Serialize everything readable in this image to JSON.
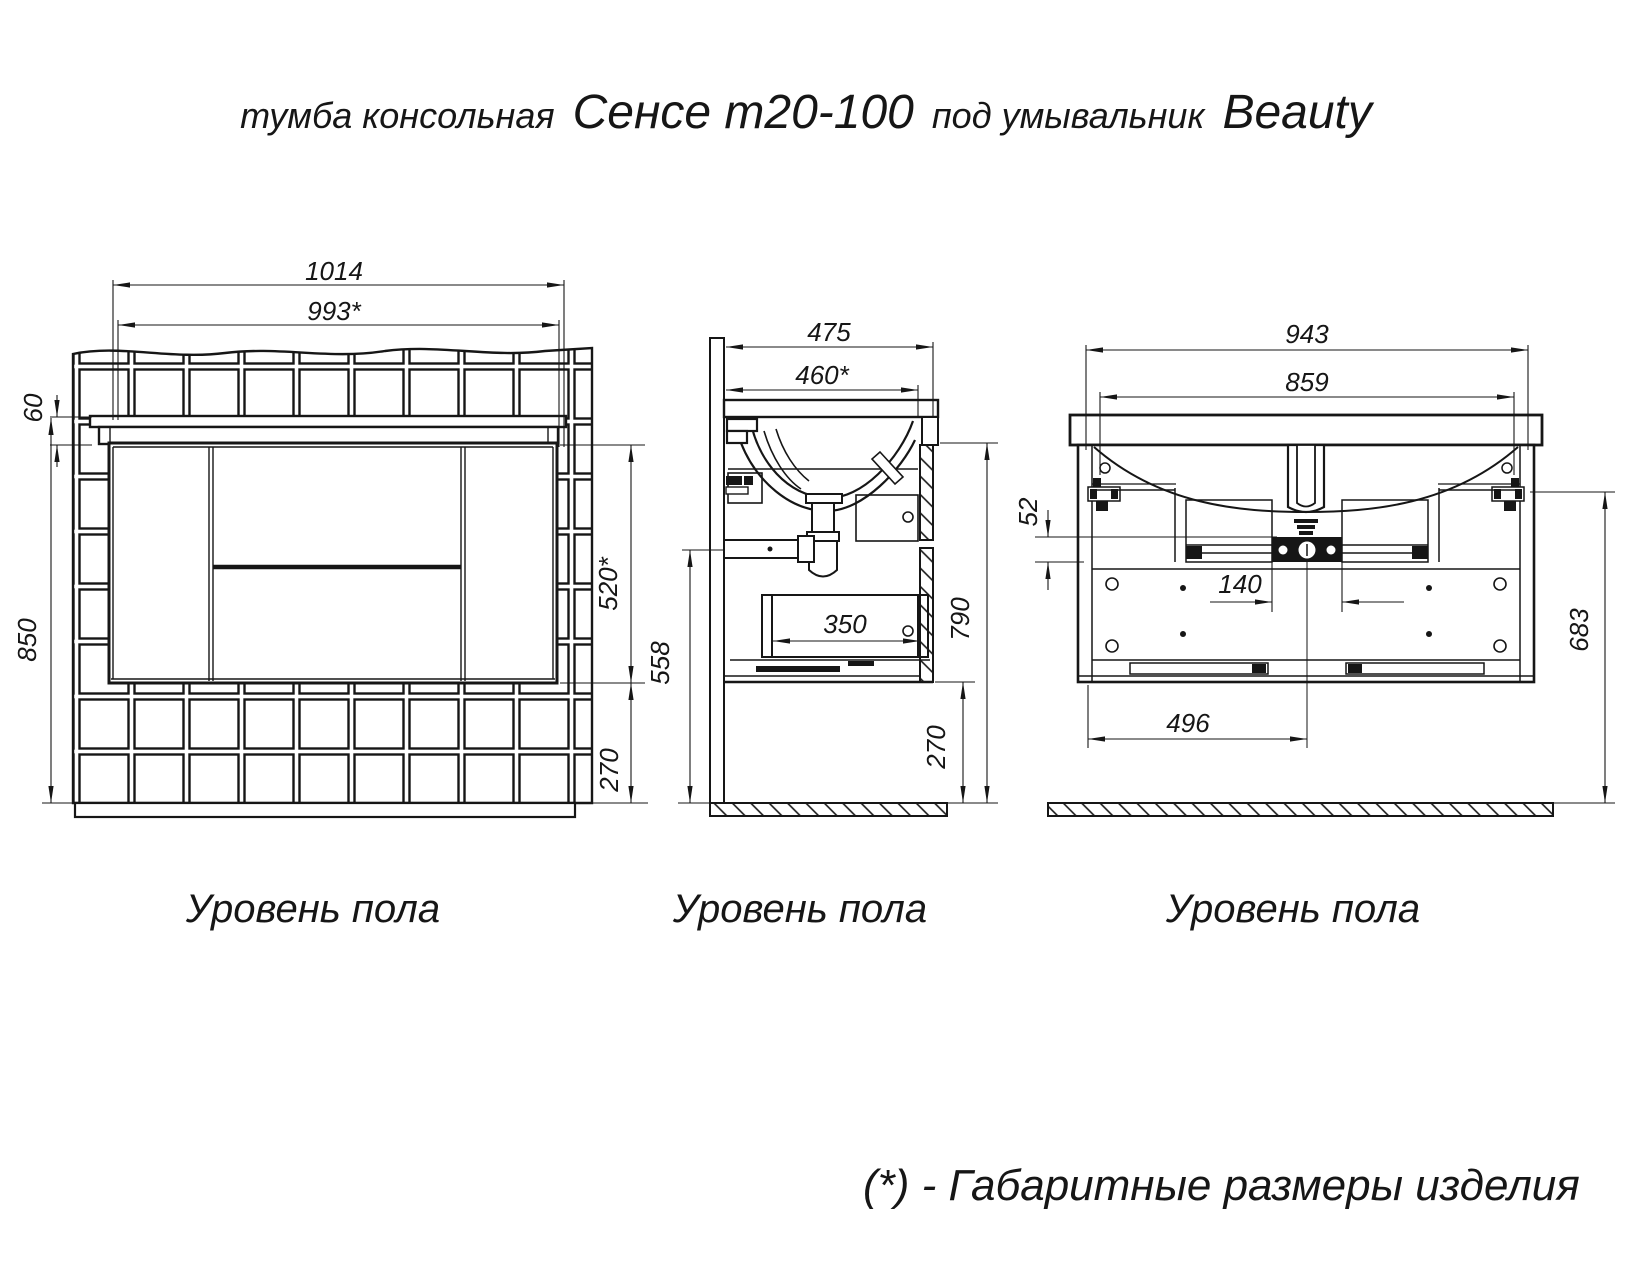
{
  "title": {
    "part1": "тумба консольная",
    "part2": "Сенсе т20-100",
    "part3": "под умывальник",
    "part4": "Beauty"
  },
  "views": {
    "front": {
      "floor_label": "Уровень пола",
      "dims": {
        "total_width": "1014",
        "product_width": "993*",
        "counter_height": "60",
        "total_height": "850",
        "cabinet_height": "520*",
        "floor_gap": "270"
      }
    },
    "side": {
      "floor_label": "Уровень пола",
      "dims": {
        "total_depth": "475",
        "product_depth": "460*",
        "drain_height": "558",
        "drawer_depth": "350",
        "front_height": "790",
        "floor_gap": "270"
      }
    },
    "back": {
      "floor_label": "Уровень пола",
      "dims": {
        "mount_width": "943",
        "inner_width": "859",
        "rail_offset": "52",
        "drain_plate_width": "140",
        "drain_offset": "496",
        "mount_height": "683"
      }
    }
  },
  "footnote": "(*) - Габаритные размеры изделия",
  "colors": {
    "line": "#161616",
    "background": "#ffffff"
  }
}
